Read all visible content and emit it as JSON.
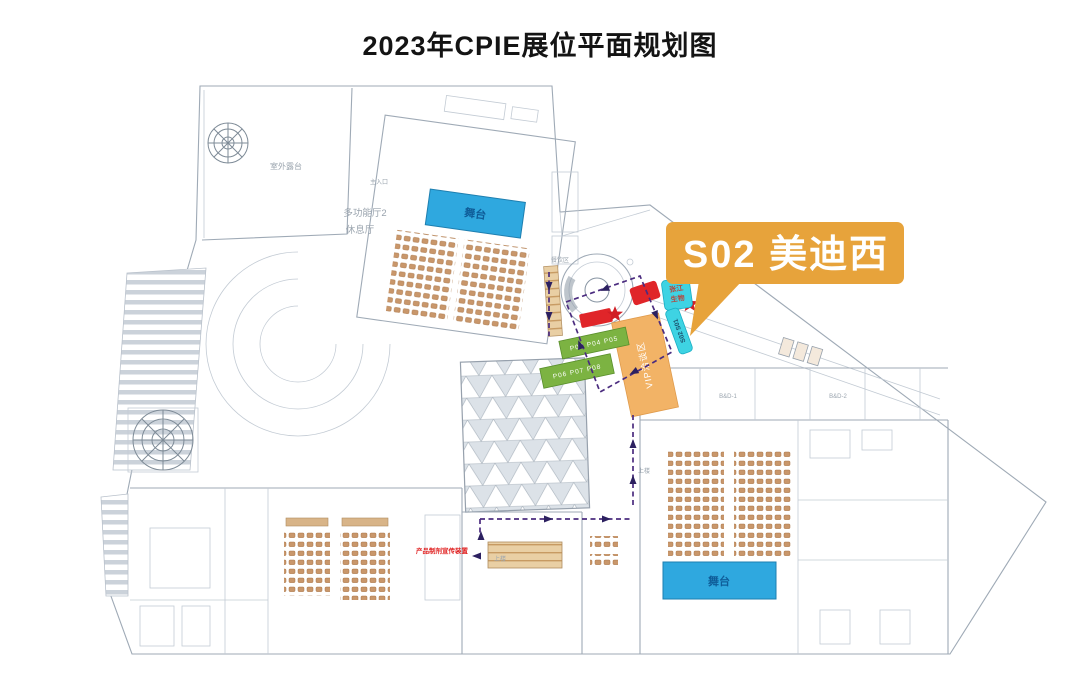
{
  "page": {
    "title": "2023年CPIE展位平面规划图"
  },
  "callout": {
    "label": "S02 美迪西",
    "booth_id": "S02",
    "company": "美迪西"
  },
  "labels": {
    "terrace": "室外露台",
    "hall2": "多功能厅2",
    "lounge": "休息厅",
    "entrance": "主入口",
    "stage_top": "舞台",
    "stage_bottom": "舞台",
    "dining": "餐饮区",
    "upstairs": "上楼",
    "vip": "VIP洽谈区",
    "zj_line1": "张江",
    "zj_line2": "生物",
    "s_bar": "S02 S01",
    "green_row1": "P03 P04 P05",
    "green_row2": "P06 P07 P08",
    "promo": "产品制剂宣传装置",
    "room1": "B&D-1",
    "room2": "B&D-2"
  },
  "colors": {
    "callout_orange": "#E7A33B",
    "stage_blue": "#2FA8DF",
    "seat_tan": "#C9976B",
    "vip_orange": "#F2B366",
    "green_booth": "#7CB342",
    "cyan_booth": "#3ED3E3",
    "red_booth": "#E02529",
    "route_purple": "#4B2C7F",
    "plan_line_gray": "#9FAAB6"
  }
}
